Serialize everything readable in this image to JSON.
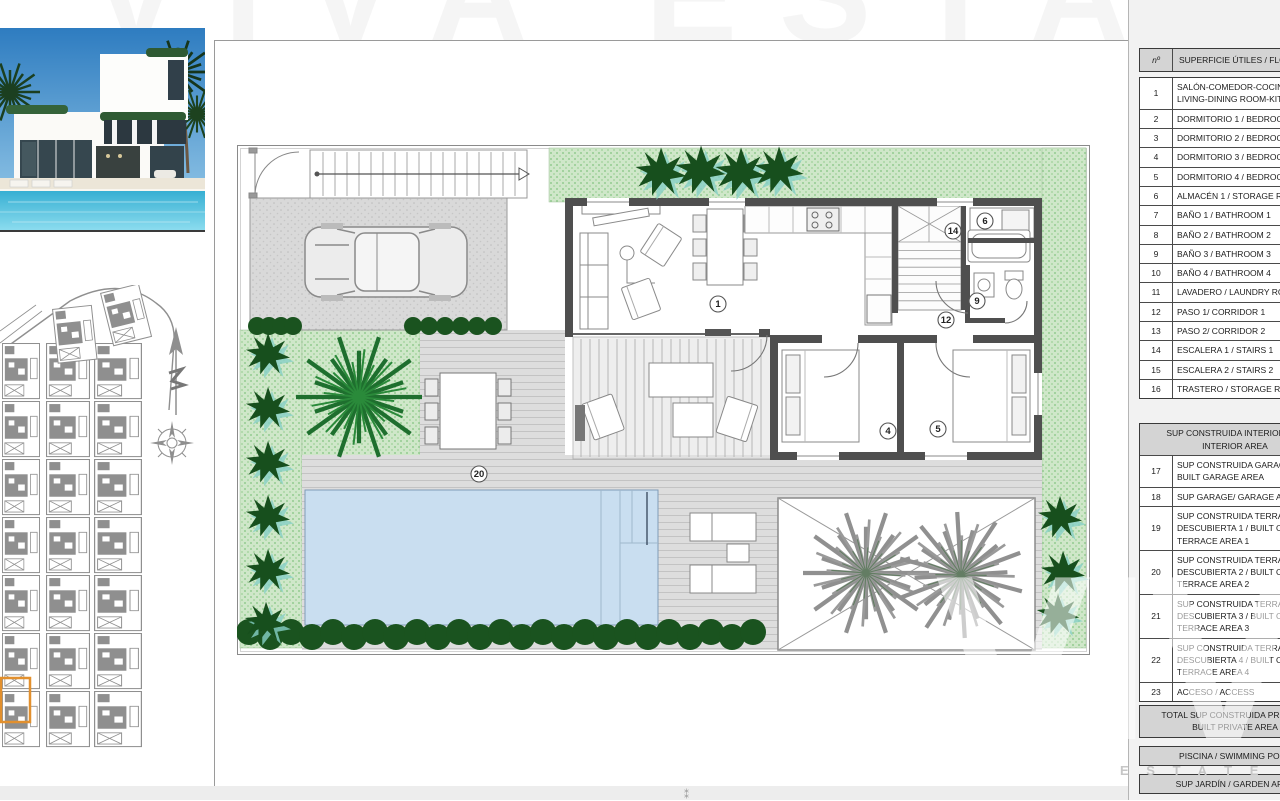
{
  "watermark": {
    "brand_big": "VIVA",
    "brand_sub": "E S T A T E",
    "top_ghost": "VIVA ESTATE",
    "fold_mark": "⁑"
  },
  "floor_plan": {
    "labels": [
      "1",
      "4",
      "5",
      "6",
      "9",
      "12",
      "14",
      "20"
    ]
  },
  "area_table": {
    "header": {
      "num": "nº",
      "desc": "SUPERFICIE ÚTILES / FLOO"
    },
    "rooms": [
      {
        "num": "1",
        "desc": "SALÓN-COMEDOR-COCIN\nLIVING-DINING ROOM-KIT"
      },
      {
        "num": "2",
        "desc": "DORMITORIO 1 / BEDROO"
      },
      {
        "num": "3",
        "desc": "DORMITORIO 2 / BEDROO"
      },
      {
        "num": "4",
        "desc": "DORMITORIO 3 / BEDROO"
      },
      {
        "num": "5",
        "desc": "DORMITORIO 4 / BEDROO"
      },
      {
        "num": "6",
        "desc": "ALMACÉN 1 / STORAGE RO"
      },
      {
        "num": "7",
        "desc": "BAÑO 1 / BATHROOM 1"
      },
      {
        "num": "8",
        "desc": "BAÑO 2 / BATHROOM 2"
      },
      {
        "num": "9",
        "desc": "BAÑO 3 / BATHROOM 3"
      },
      {
        "num": "10",
        "desc": "BAÑO 4 / BATHROOM 4"
      },
      {
        "num": "11",
        "desc": "LAVADERO / LAUNDRY RO"
      },
      {
        "num": "12",
        "desc": "PASO 1/ CORRIDOR 1"
      },
      {
        "num": "13",
        "desc": "PASO 2/ CORRIDOR 2"
      },
      {
        "num": "14",
        "desc": "ESCALERA 1 / STAIRS 1"
      },
      {
        "num": "15",
        "desc": "ESCALERA 2 / STAIRS 2"
      },
      {
        "num": "16",
        "desc": "TRASTERO / STORAGE RO"
      }
    ],
    "built_header": "SUP CONSTRUIDA INTERIOR / BU\nINTERIOR AREA",
    "built_rows": [
      {
        "num": "17",
        "desc": "SUP CONSTRUIDA GARAG\nBUILT GARAGE AREA"
      },
      {
        "num": "18",
        "desc": "SUP GARAGE/ GARAGE AR"
      },
      {
        "num": "19",
        "desc": "SUP CONSTRUIDA TERRAZ\nDESCUBIERTA 1 / BUILT O\nTERRACE AREA 1"
      },
      {
        "num": "20",
        "desc": "SUP CONSTRUIDA TERRAZ\nDESCUBIERTA 2 / BUILT O\nTERRACE AREA 2"
      },
      {
        "num": "21",
        "desc": "SUP CONSTRUIDA TERRAZ\nDESCUBIERTA 3 / BUILT O\nTERRACE AREA 3"
      },
      {
        "num": "22",
        "desc": "SUP CONSTRUIDA TERRAZ\nDESCUBIERTA 4 / BUILT O\nTERRACE AREA 4"
      },
      {
        "num": "23",
        "desc": "ACCESO / ACCESS"
      }
    ],
    "total": "TOTAL SUP CONSTRUIDA PRIVADA /\nBUILT PRIVATE AREA",
    "summary_bars": [
      "PISCINA / SWIMMING POOL",
      "SUP JARDÍN / GARDEN AREA",
      "SUPERFICIE PARCELA / PLOT AR"
    ]
  }
}
